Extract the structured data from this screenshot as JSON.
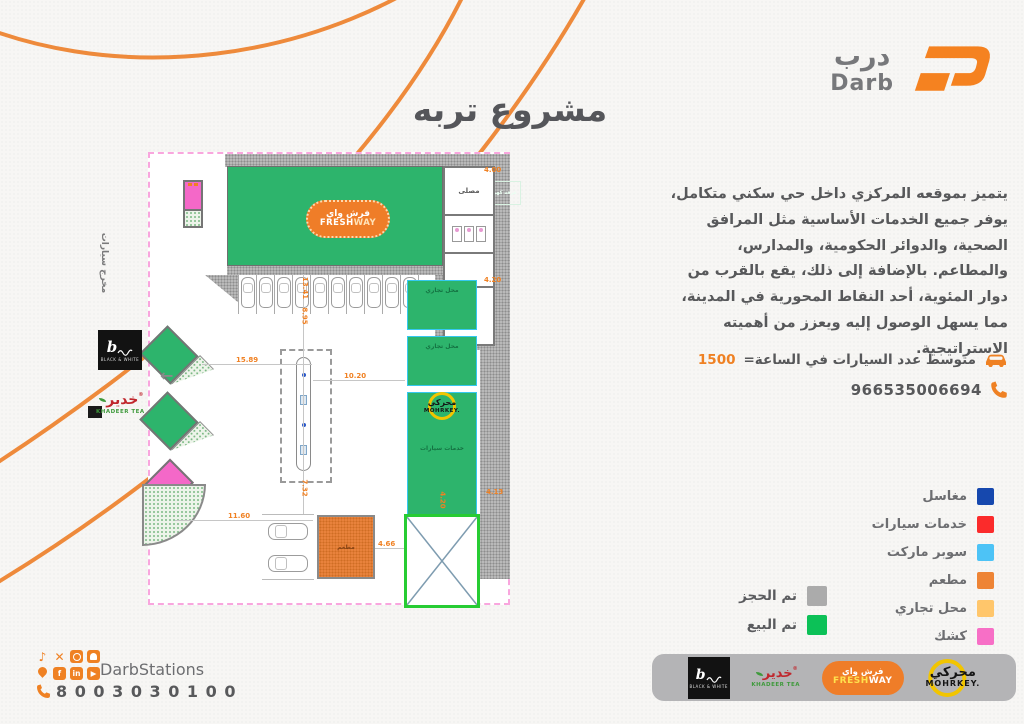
{
  "brand": {
    "name_ar": "درب",
    "name_en": "Darb"
  },
  "title": "مشروع تربه",
  "description": "يتميز بموقعه المركزي داخل حي سكني متكامل،\nيوفر جميع الخدمات الأساسية مثل المرافق\nالصحية، والدوائر الحكومية، والمدارس،\nوالمطاعم. بالإضافة إلى ذلك، يقع بالقرب من\nدوار المئوية، أحد النقاط المحورية في المدينة،\nمما يسهل الوصول إليه ويعزز من أهميته\nالاستراتيجية.",
  "stats": {
    "avg_cars_label": "متوسط عدد السيارات في الساعة=",
    "avg_cars_value": "1500",
    "phone": "966535006694"
  },
  "legend": {
    "items": [
      {
        "label": "مغاسل",
        "color": "#1648AE"
      },
      {
        "label": "خدمات سيارات",
        "color": "#FB2B2B"
      },
      {
        "label": "سوبر ماركت",
        "color": "#4DC3F6"
      },
      {
        "label": "مطعم",
        "color": "#EE8435"
      },
      {
        "label": "محل تجاري",
        "color": "#FFC66B"
      },
      {
        "label": "كشك",
        "color": "#F76FC6"
      }
    ]
  },
  "status_legend": [
    {
      "label": "تم الحجز",
      "color": "#ABABAB"
    },
    {
      "label": "تم البيع",
      "color": "#0CC157"
    }
  ],
  "plan": {
    "exit_label": "مخرج سيارات",
    "electricity_room": "غرفة كهرباء",
    "prayer_room": "مصلى",
    "admin_room": "إداره",
    "shop_label": "محل تجاري",
    "car_services_label": "خدمات سيارات",
    "laundry_label": "مغسلة",
    "restaurant_label": "مطعم",
    "freshway": {
      "ar": "فرش واي",
      "en_bold": "FRESH",
      "en_light": "WAY"
    },
    "mohrkey": {
      "ar": "محركي",
      "en": "MOHRKEY."
    },
    "dims": [
      "4.00",
      "4.20",
      "4.13",
      "10.20",
      "15.89",
      "11.60",
      "4.66",
      "8.95",
      "13.41",
      "7.32",
      "4.20"
    ]
  },
  "footer": {
    "handle": "DarbStations",
    "phone": "8 0 0 3 0 3 0 1 0 0",
    "social": {
      "tiktok": "♪",
      "x": "✕",
      "facebook": "f",
      "linkedin": "in",
      "youtube": "▶"
    },
    "partners": {
      "black_white": {
        "glyph": "b",
        "caption": "BLACK & WHITE"
      },
      "khadeer": {
        "ar": "خدير",
        "en": "KHADEER TEA",
        "reg": "®"
      },
      "freshway": {
        "ar": "فرش واي",
        "en_bold": "FRESH",
        "en_light": "WAY"
      },
      "mohrkey": {
        "ar": "محركي",
        "en": "MOHRKEY."
      }
    }
  },
  "colors": {
    "accent": "#EF8123",
    "text": "#57585A",
    "plan_green": "#2DB46C",
    "plan_pink": "#F468C8",
    "plan_orange": "#E8823C",
    "boundary": "#F9A6DE"
  }
}
